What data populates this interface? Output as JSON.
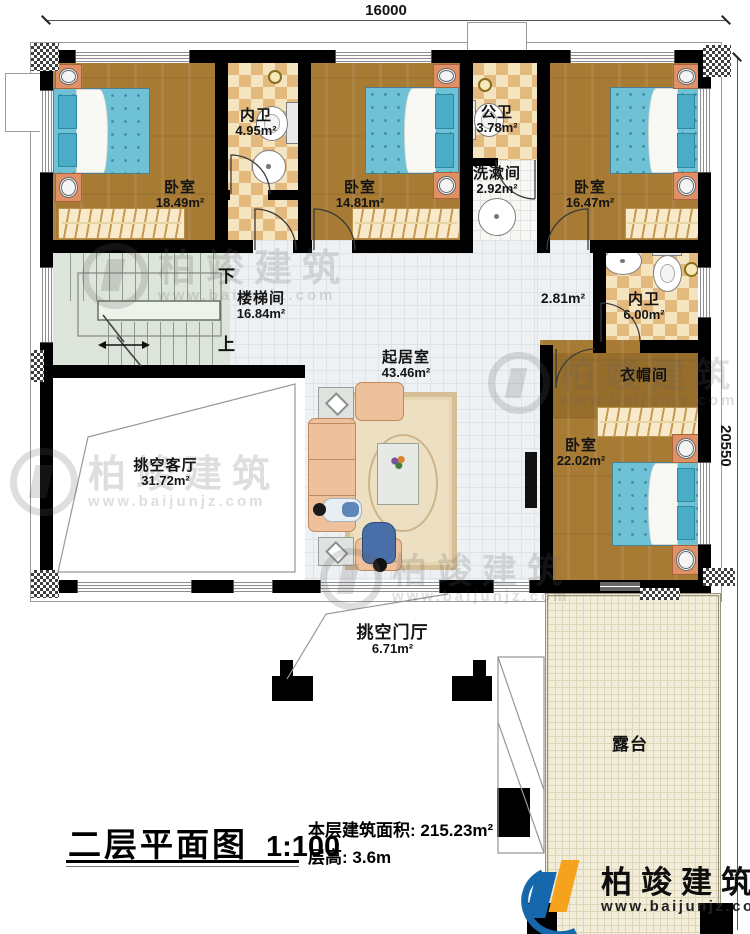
{
  "dims": {
    "top": "16000",
    "right": "20550"
  },
  "rooms": {
    "bedroom1": {
      "name": "卧室",
      "area": "18.49m²"
    },
    "ensuite1": {
      "name": "内卫",
      "area": "4.95m²"
    },
    "bedroom2": {
      "name": "卧室",
      "area": "14.81m²"
    },
    "publicbath": {
      "name": "公卫",
      "area": "3.78m²"
    },
    "washroom": {
      "name": "洗漱间",
      "area": "2.92m²"
    },
    "bedroom3": {
      "name": "卧室",
      "area": "16.47m²"
    },
    "stair": {
      "name": "楼梯间",
      "area": "16.84m²",
      "down": "下",
      "up": "上"
    },
    "living": {
      "name": "起居室",
      "area": "43.46m²"
    },
    "hall": {
      "area": "2.81m²"
    },
    "ensuite2": {
      "name": "内卫",
      "area": "6.00m²"
    },
    "cloak": {
      "name": "衣帽间"
    },
    "bedroom4": {
      "name": "卧室",
      "area": "22.02m²"
    },
    "voidliving": {
      "name": "挑空客厅",
      "area": "31.72m²"
    },
    "voidfoyer": {
      "name": "挑空门厅",
      "area": "6.71m²"
    },
    "terrace": {
      "name": "露台"
    }
  },
  "footer": {
    "title": "二层平面图",
    "scale": "1:100",
    "area_label": "本层建筑面积:",
    "area_value": "215.23m²",
    "height_label": "层高:",
    "height_value": "3.6m"
  },
  "brand": {
    "name": "柏竣建筑",
    "url": "www.baijunjz.com"
  },
  "colors": {
    "wall": "#000000",
    "wood_floor": "#a87b35",
    "bed_blue": "#6fc2d6",
    "bath_tile": "#e3b97e",
    "living_tile": "#eef1f3",
    "terrace_tile": "#f2edd9",
    "logo_blue": "#1668ad",
    "logo_orange": "#f6a21c"
  }
}
